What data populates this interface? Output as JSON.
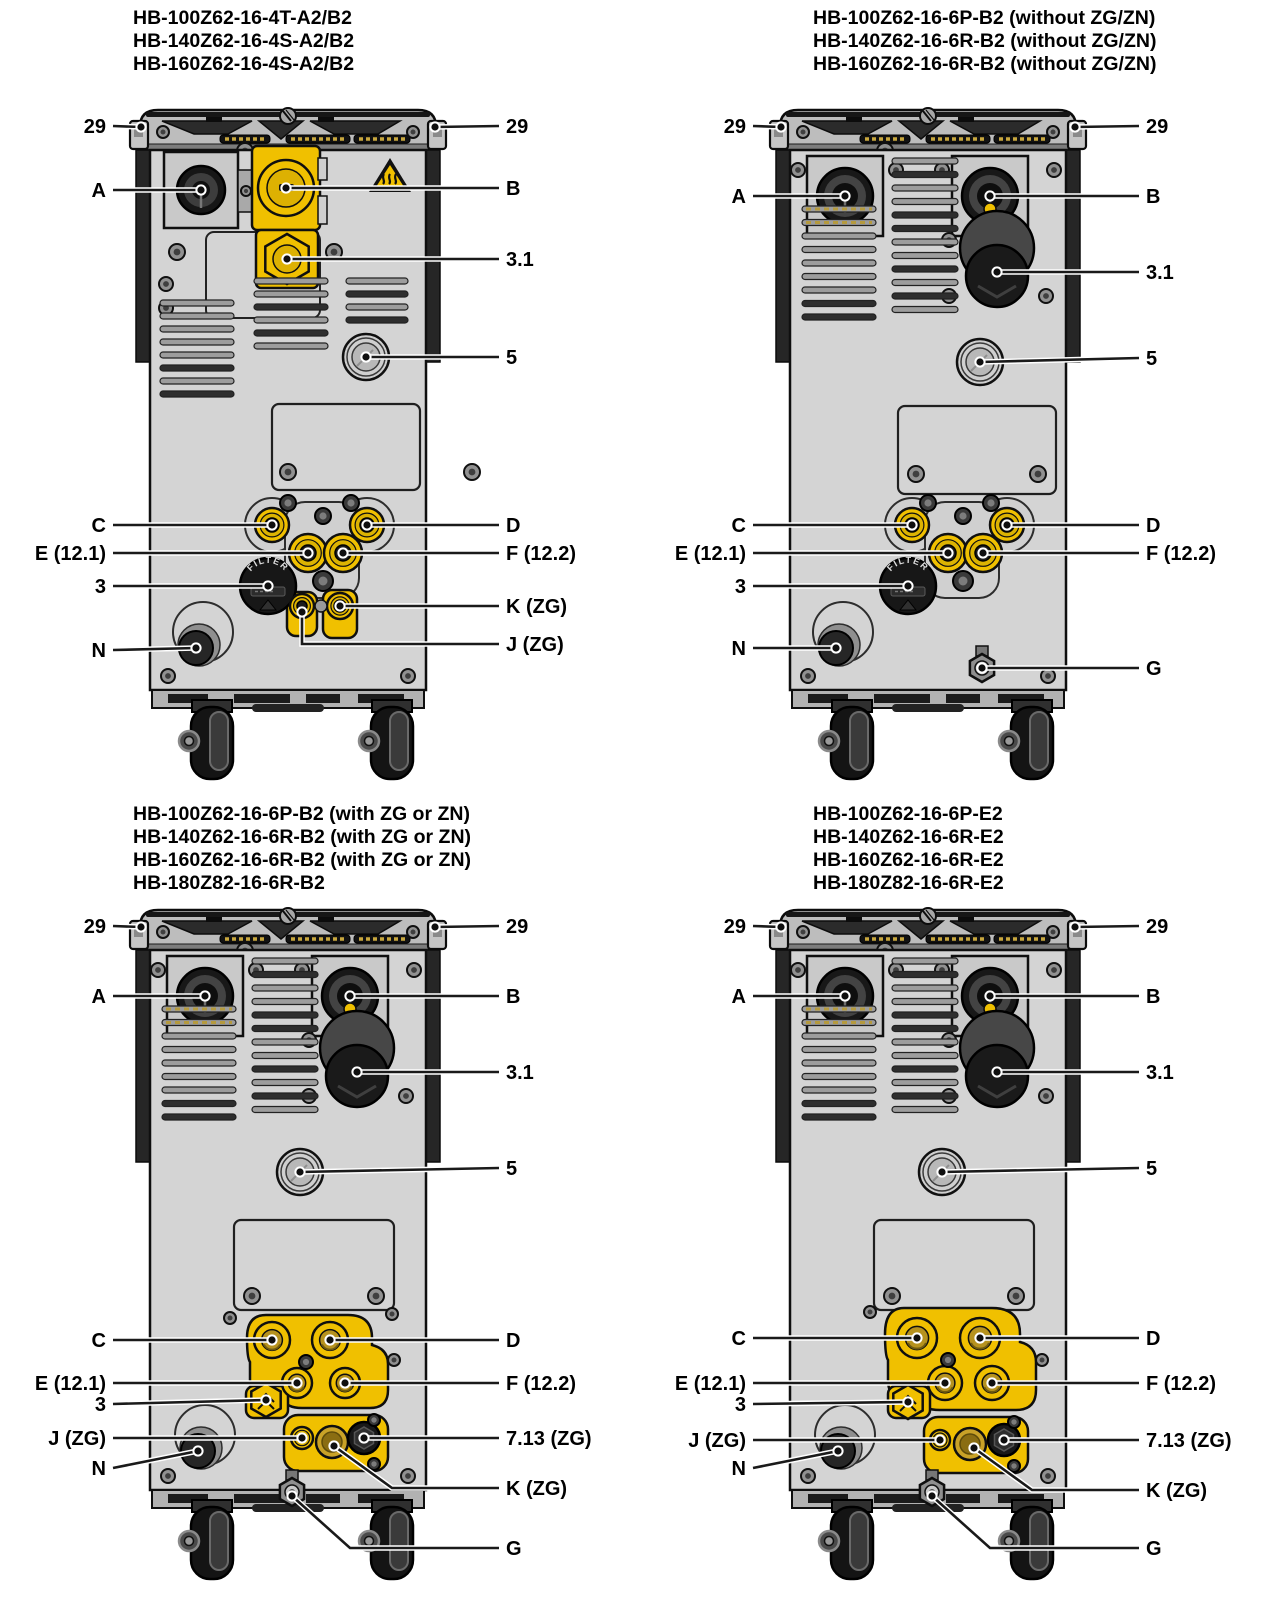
{
  "colors": {
    "accent_yellow": "#f0c000",
    "brass": "#b6921e",
    "machine_gray": "#d4d4d4",
    "cap_gray": "#bdbdbd",
    "outline": "#0f0f0f",
    "leader_line": "#1a1a1a",
    "label_text": "#000000"
  },
  "panels": [
    {
      "id": "top-left",
      "variant": "v1",
      "title_lines": [
        "HB-100Z62-16-4T-A2/B2",
        "HB-140Z62-16-4S-A2/B2",
        "HB-160Z62-16-4S-A2/B2"
      ],
      "filter_label": "FILTER",
      "callouts": [
        {
          "label": "29",
          "side": "left",
          "y": 126,
          "tx": 141,
          "ty": 127
        },
        {
          "label": "29",
          "side": "right",
          "y": 126,
          "tx": 435,
          "ty": 127
        },
        {
          "label": "A",
          "side": "left",
          "y": 190,
          "tx": 201,
          "ty": 190
        },
        {
          "label": "B",
          "side": "right",
          "y": 188,
          "tx": 286,
          "ty": 188
        },
        {
          "label": "3.1",
          "side": "right",
          "y": 259,
          "tx": 287,
          "ty": 259
        },
        {
          "label": "5",
          "side": "right",
          "y": 357,
          "tx": 366,
          "ty": 357
        },
        {
          "label": "C",
          "side": "left",
          "y": 525,
          "tx": 272,
          "ty": 525
        },
        {
          "label": "D",
          "side": "right",
          "y": 525,
          "tx": 367,
          "ty": 525
        },
        {
          "label": "E (12.1)",
          "side": "left",
          "y": 553,
          "tx": 308,
          "ty": 553
        },
        {
          "label": "F (12.2)",
          "side": "right",
          "y": 553,
          "tx": 343,
          "ty": 553
        },
        {
          "label": "3",
          "side": "left",
          "y": 586,
          "tx": 268,
          "ty": 586
        },
        {
          "label": "K (ZG)",
          "side": "right",
          "y": 606,
          "tx": 340,
          "ty": 606
        },
        {
          "label": "J (ZG)",
          "side": "right",
          "y": 644,
          "tx": 302,
          "ty": 612,
          "points": [
            [
              302,
              612
            ],
            [
              302,
              644
            ],
            [
              499,
              644
            ]
          ]
        },
        {
          "label": "N",
          "side": "left",
          "y": 650,
          "tx": 196,
          "ty": 648
        }
      ]
    },
    {
      "id": "top-right",
      "variant": "v2",
      "title_lines": [
        "HB-100Z62-16-6P-B2 (without ZG/ZN)",
        "HB-140Z62-16-6R-B2 (without ZG/ZN)",
        "HB-160Z62-16-6R-B2 (without ZG/ZN)"
      ],
      "filter_label": "FILTER",
      "callouts": [
        {
          "label": "29",
          "side": "left",
          "y": 126,
          "tx": 141,
          "ty": 127
        },
        {
          "label": "29",
          "side": "right",
          "y": 126,
          "tx": 435,
          "ty": 127
        },
        {
          "label": "A",
          "side": "left",
          "y": 196,
          "tx": 205,
          "ty": 196
        },
        {
          "label": "B",
          "side": "right",
          "y": 196,
          "tx": 350,
          "ty": 196
        },
        {
          "label": "3.1",
          "side": "right",
          "y": 272,
          "tx": 357,
          "ty": 272
        },
        {
          "label": "5",
          "side": "right",
          "y": 358,
          "tx": 340,
          "ty": 362
        },
        {
          "label": "C",
          "side": "left",
          "y": 525,
          "tx": 272,
          "ty": 525
        },
        {
          "label": "D",
          "side": "right",
          "y": 525,
          "tx": 367,
          "ty": 525
        },
        {
          "label": "E (12.1)",
          "side": "left",
          "y": 553,
          "tx": 308,
          "ty": 553
        },
        {
          "label": "F (12.2)",
          "side": "right",
          "y": 553,
          "tx": 343,
          "ty": 553
        },
        {
          "label": "3",
          "side": "left",
          "y": 586,
          "tx": 268,
          "ty": 586
        },
        {
          "label": "N",
          "side": "left",
          "y": 648,
          "tx": 196,
          "ty": 648
        },
        {
          "label": "G",
          "side": "right",
          "y": 668,
          "tx": 342,
          "ty": 668
        }
      ]
    },
    {
      "id": "bottom-left",
      "variant": "v3",
      "title_lines": [
        "HB-100Z62-16-6P-B2 (with ZG or ZN)",
        "HB-140Z62-16-6R-B2 (with ZG or ZN)",
        "HB-160Z62-16-6R-B2 (with ZG or ZN)",
        "HB-180Z82-16-6R-B2"
      ],
      "callouts": [
        {
          "label": "29",
          "side": "left",
          "y": 126,
          "tx": 141,
          "ty": 127
        },
        {
          "label": "29",
          "side": "right",
          "y": 126,
          "tx": 435,
          "ty": 127
        },
        {
          "label": "A",
          "side": "left",
          "y": 196,
          "tx": 205,
          "ty": 196
        },
        {
          "label": "B",
          "side": "right",
          "y": 196,
          "tx": 350,
          "ty": 196
        },
        {
          "label": "3.1",
          "side": "right",
          "y": 272,
          "tx": 357,
          "ty": 272
        },
        {
          "label": "5",
          "side": "right",
          "y": 368,
          "tx": 300,
          "ty": 372
        },
        {
          "label": "C",
          "side": "left",
          "y": 540,
          "tx": 272,
          "ty": 540
        },
        {
          "label": "D",
          "side": "right",
          "y": 540,
          "tx": 330,
          "ty": 540
        },
        {
          "label": "E (12.1)",
          "side": "left",
          "y": 583,
          "tx": 297,
          "ty": 583
        },
        {
          "label": "F (12.2)",
          "side": "right",
          "y": 583,
          "tx": 345,
          "ty": 583
        },
        {
          "label": "3",
          "side": "left",
          "y": 604,
          "tx": 266,
          "ty": 600
        },
        {
          "label": "J (ZG)",
          "side": "left",
          "y": 638,
          "tx": 302,
          "ty": 638
        },
        {
          "label": "7.13 (ZG)",
          "side": "right",
          "y": 638,
          "tx": 364,
          "ty": 638
        },
        {
          "label": "K (ZG)",
          "side": "right",
          "y": 688,
          "tx": 334,
          "ty": 646,
          "points": [
            [
              334,
              646
            ],
            [
              392,
              688
            ],
            [
              499,
              688
            ]
          ]
        },
        {
          "label": "N",
          "side": "left",
          "y": 668,
          "tx": 198,
          "ty": 651
        },
        {
          "label": "G",
          "side": "right",
          "y": 748,
          "tx": 292,
          "ty": 696,
          "points": [
            [
              292,
              696
            ],
            [
              350,
              748
            ],
            [
              499,
              748
            ]
          ]
        }
      ]
    },
    {
      "id": "bottom-right",
      "variant": "v4",
      "title_lines": [
        "HB-100Z62-16-6P-E2",
        "HB-140Z62-16-6R-E2",
        "HB-160Z62-16-6R-E2",
        "HB-180Z82-16-6R-E2"
      ],
      "callouts": [
        {
          "label": "29",
          "side": "left",
          "y": 126,
          "tx": 141,
          "ty": 127
        },
        {
          "label": "29",
          "side": "right",
          "y": 126,
          "tx": 435,
          "ty": 127
        },
        {
          "label": "A",
          "side": "left",
          "y": 196,
          "tx": 205,
          "ty": 196
        },
        {
          "label": "B",
          "side": "right",
          "y": 196,
          "tx": 350,
          "ty": 196
        },
        {
          "label": "3.1",
          "side": "right",
          "y": 272,
          "tx": 357,
          "ty": 272
        },
        {
          "label": "5",
          "side": "right",
          "y": 368,
          "tx": 302,
          "ty": 372
        },
        {
          "label": "C",
          "side": "left",
          "y": 538,
          "tx": 277,
          "ty": 538
        },
        {
          "label": "D",
          "side": "right",
          "y": 538,
          "tx": 340,
          "ty": 538
        },
        {
          "label": "E (12.1)",
          "side": "left",
          "y": 583,
          "tx": 305,
          "ty": 583
        },
        {
          "label": "F (12.2)",
          "side": "right",
          "y": 583,
          "tx": 352,
          "ty": 583
        },
        {
          "label": "3",
          "side": "left",
          "y": 604,
          "tx": 268,
          "ty": 602
        },
        {
          "label": "J (ZG)",
          "side": "left",
          "y": 640,
          "tx": 300,
          "ty": 640
        },
        {
          "label": "7.13 (ZG)",
          "side": "right",
          "y": 640,
          "tx": 364,
          "ty": 640
        },
        {
          "label": "K (ZG)",
          "side": "right",
          "y": 690,
          "tx": 334,
          "ty": 648,
          "points": [
            [
              334,
              648
            ],
            [
              392,
              690
            ],
            [
              499,
              690
            ]
          ]
        },
        {
          "label": "N",
          "side": "left",
          "y": 668,
          "tx": 198,
          "ty": 651
        },
        {
          "label": "G",
          "side": "right",
          "y": 748,
          "tx": 292,
          "ty": 696,
          "points": [
            [
              292,
              696
            ],
            [
              350,
              748
            ],
            [
              499,
              748
            ]
          ]
        }
      ]
    }
  ]
}
